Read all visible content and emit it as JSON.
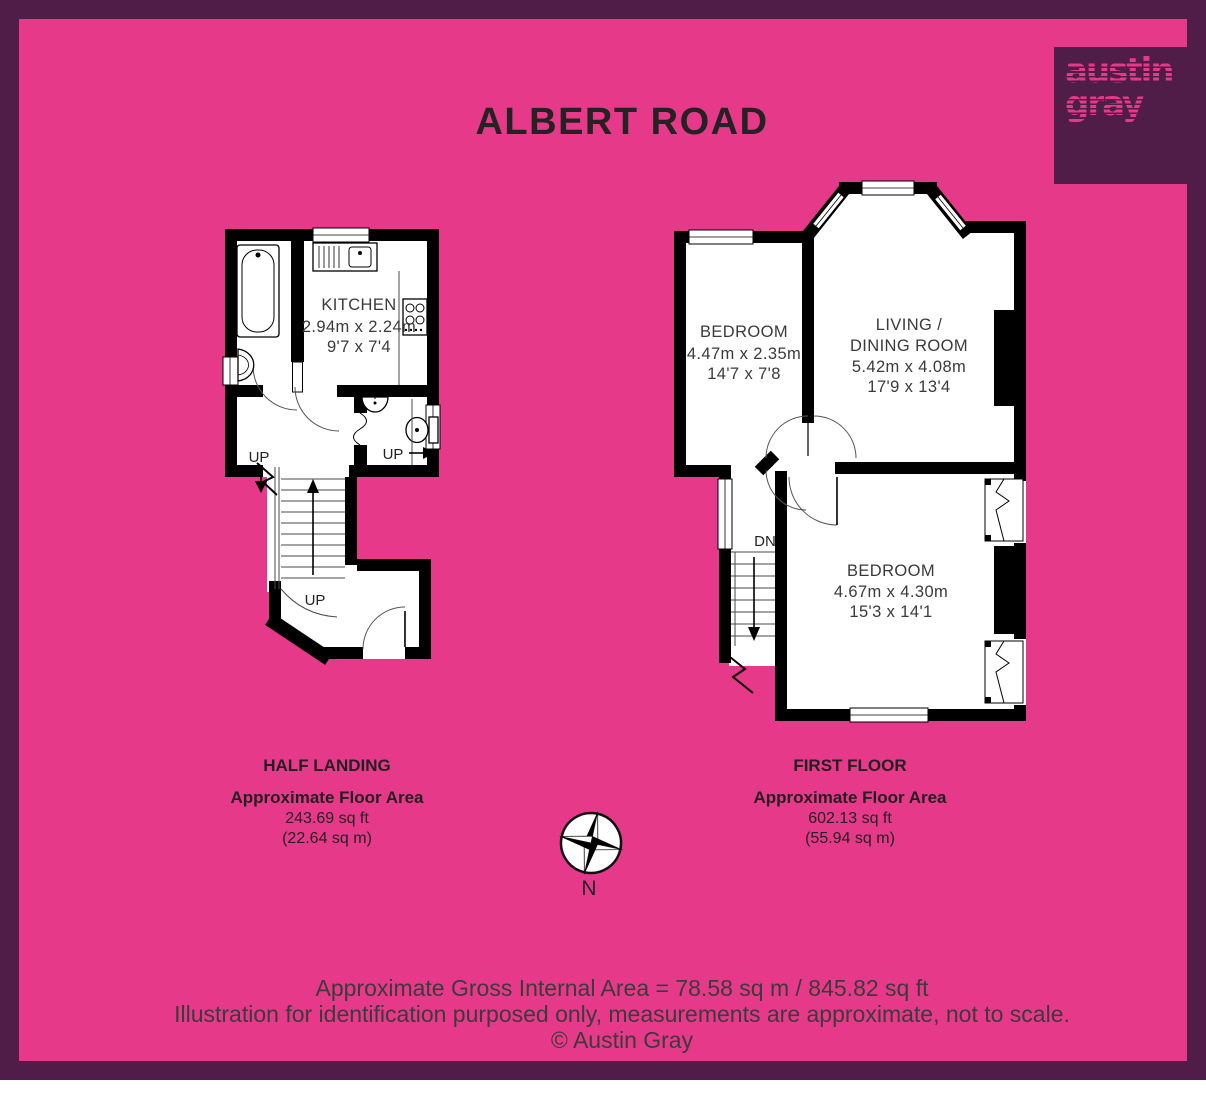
{
  "title": "ALBERT ROAD",
  "logo": {
    "line1": "austin",
    "line2": "gray"
  },
  "colors": {
    "background": "#E7398A",
    "border": "#4F1D47",
    "logo_square": "#4F1D47",
    "logo_text": "#E7398A",
    "walls": "#000000",
    "plan_text": "#3A3A3A"
  },
  "half_landing": {
    "floor_name": "HALF LANDING",
    "area_heading": "Approximate Floor Area",
    "area_imperial": "243.69 sq ft",
    "area_metric": "(22.64 sq m)",
    "kitchen_name": "KITCHEN",
    "kitchen_metric": "2.94m x 2.24m",
    "kitchen_imperial": "9'7 x 7'4",
    "up_hall": "UP",
    "up_wc": "UP",
    "up_stairs": "UP"
  },
  "first_floor": {
    "floor_name": "FIRST FLOOR",
    "area_heading": "Approximate Floor Area",
    "area_imperial": "602.13 sq ft",
    "area_metric": "(55.94 sq m)",
    "bedroom_front_name": "BEDROOM",
    "bedroom_front_metric": "4.47m x 2.35m",
    "bedroom_front_imperial": "14'7 x 7'8",
    "living_name_line1": "LIVING /",
    "living_name_line2": "DINING ROOM",
    "living_metric": "5.42m x 4.08m",
    "living_imperial": "17'9 x 13'4",
    "bedroom_back_name": "BEDROOM",
    "bedroom_back_metric": "4.67m x 4.30m",
    "bedroom_back_imperial": "15'3 x 14'1",
    "down_label": "DN"
  },
  "compass": {
    "north": "N"
  },
  "footer": {
    "line1": "Approximate Gross Internal Area = 78.58 sq m / 845.82 sq ft",
    "line2": "Illustration for identification purposed only, measurements are approximate, not to scale.",
    "line3": "© Austin Gray"
  }
}
